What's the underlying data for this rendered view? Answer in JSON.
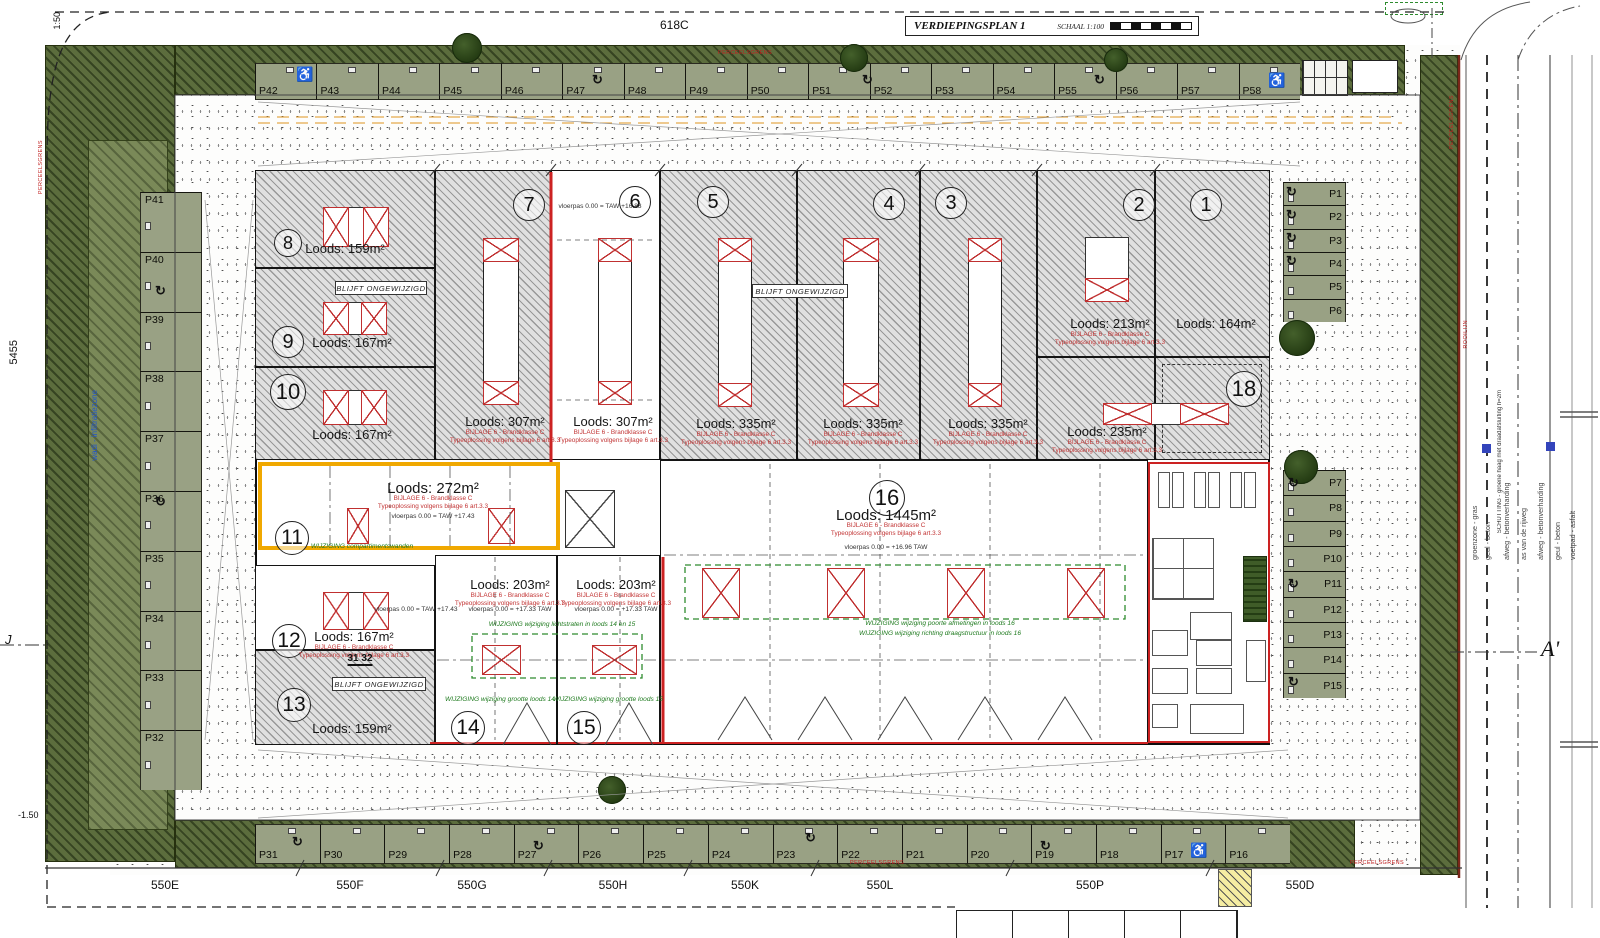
{
  "meta": {
    "plot_label": "618C",
    "title": "VERDIEPINGSPLAN 1",
    "scale": "SCHAAL 1:100",
    "dim_left": "5455",
    "corner_scale": "1:50",
    "level_left": "-1.50",
    "section_left": "J",
    "section_right": "A'"
  },
  "parking": {
    "top_row": [
      "P42",
      "P43",
      "P44",
      "P45",
      "P46",
      "P47",
      "P48",
      "P49",
      "P50",
      "P51",
      "P52",
      "P53",
      "P54",
      "P55",
      "P56",
      "P57",
      "P58"
    ],
    "bottom_row": [
      "P31",
      "P30",
      "P29",
      "P28",
      "P27",
      "P26",
      "P25",
      "P24",
      "P23",
      "P22",
      "P21",
      "P20",
      "P19",
      "P18",
      "P17",
      "P16"
    ],
    "left_col": [
      "P41",
      "P40",
      "P39",
      "P38",
      "P37",
      "P36",
      "P35",
      "P34",
      "P33",
      "P32"
    ],
    "right_upper": [
      "P1",
      "P2",
      "P3",
      "P4",
      "P5",
      "P6"
    ],
    "right_lower": [
      "P7",
      "P8",
      "P9",
      "P10",
      "P11",
      "P12",
      "P13",
      "P14",
      "P15"
    ]
  },
  "streets": [
    "550E",
    "550F",
    "550G",
    "550H",
    "550K",
    "550L",
    "550P",
    "550D"
  ],
  "roads": {
    "labels": [
      "groenzone - gras",
      "geul - beton",
      "afweg - betonverharding",
      "as van de rijweg",
      "afweg - betonverharding",
      "geul - beton",
      "voetpad - asfalt"
    ]
  },
  "units": {
    "u1": {
      "num": "1",
      "area": "Loods: 164m²"
    },
    "u2": {
      "num": "2",
      "area": "Loods: 213m²"
    },
    "u2b": {
      "area": "Loods: 235m²"
    },
    "u3": {
      "num": "3",
      "area": "Loods: 335m²"
    },
    "u4": {
      "num": "4",
      "area": "Loods: 335m²"
    },
    "u5": {
      "num": "5",
      "area": "Loods: 335m²"
    },
    "u6": {
      "num": "6",
      "area": "Loods: 307m²",
      "level": "vloerpas 0.00 = TAW +16.83"
    },
    "u7": {
      "num": "7",
      "area": "Loods: 307m²"
    },
    "u8": {
      "num": "8",
      "area": "Loods: 159m²"
    },
    "u9": {
      "num": "9",
      "area": "Loods: 167m²"
    },
    "u10": {
      "num": "10",
      "area": "Loods: 167m²"
    },
    "u11": {
      "num": "11",
      "area": "Loods: 272m²",
      "level": "vloerpas 0.00 = TAW +17.43",
      "note_change": "WIJZIGING compartimentswanden"
    },
    "u12": {
      "num": "12",
      "area": "Loods: 167m²",
      "level": "vloerpas 0.00 = TAW +17.43",
      "dim": "31 32"
    },
    "u13": {
      "num": "13",
      "area": "Loods: 159m²"
    },
    "u14": {
      "num": "14",
      "area": "Loods: 203m²",
      "level": "vloerpas 0.00 = +17.33 TAW",
      "note_change": "WIJZIGING wijziging grootte loods 14"
    },
    "u15": {
      "num": "15",
      "area": "Loods: 203m²",
      "level": "vloerpas 0.00 = +17.33 TAW",
      "note_change": "WIJZIGING wijziging grootte loods 15"
    },
    "u16": {
      "num": "16",
      "area": "Loods: 1445m²",
      "level": "vloerpas 0.00 = +16.96 TAW",
      "note_change": "WIJZIGING wijziging poorte afmetingen in loods 16",
      "note_change2": "WIJZIGING wijziging richting draagstructuur in loods 16"
    },
    "u18": {
      "num": "18"
    }
  },
  "notes": {
    "unchanged": "BLIJFT ONGEWIJZIGD",
    "fire_class": "BIJLAGE 6 - Brandklasse C",
    "type_solution": "Typeoplossing volgens bijlage 6 art.3.3",
    "lichtstraten": "WIJZIGING wijziging lichtstraten in loods 14 en 15",
    "parcel_boundary": "PERCEELSGRENS",
    "rooilijn": "ROOILIJN",
    "wadi": "wadi - infiltratiezone",
    "schutting": "SCHUTTING - groene haag met draadafsluiting h=2m"
  },
  "icons": {
    "wheelchair": "♿",
    "turn_arrow": "↻"
  },
  "colors": {
    "accent_orange": "#f0a800",
    "red": "#cc2222",
    "green_note": "#1e7a1e",
    "stall_olive": "#99a184",
    "deep_green": "#5c6d3d"
  }
}
